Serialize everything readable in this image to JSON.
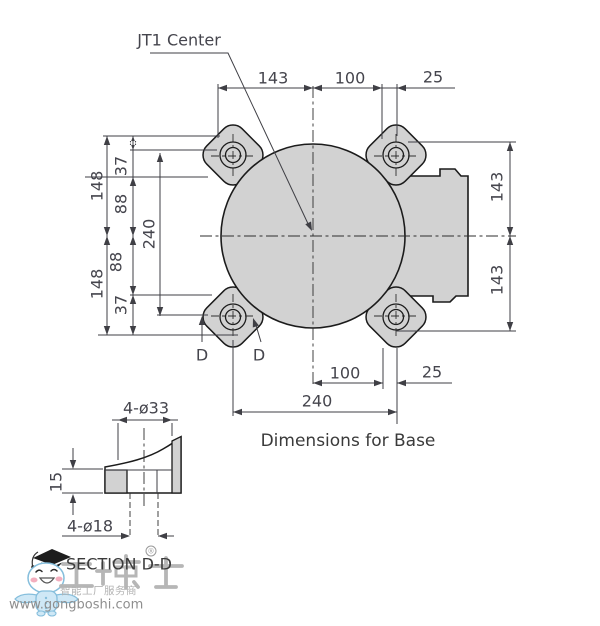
{
  "drawing": {
    "callout": "JT1 Center",
    "caption": "Dimensions for Base",
    "cut_labels": {
      "left": "D",
      "right": "D"
    },
    "dims": {
      "top": [
        "143",
        "100",
        "25"
      ],
      "bottom": [
        "100",
        "25",
        "240"
      ],
      "left": [
        "148",
        "37",
        "88",
        "240",
        "88",
        "37",
        "148"
      ],
      "right": [
        "143",
        "143"
      ]
    },
    "section": {
      "caption": "SECTION D-D",
      "counterbore": "4-ø33",
      "thickness": "15",
      "through_hole": "4-ø18"
    }
  },
  "watermark": {
    "brand": "工博士",
    "registered": "®",
    "tagline": "智能工厂服务商",
    "url": "www.gongboshi.com"
  },
  "colors": {
    "part_fill": "#d2d2d2",
    "outline": "#1b1b1b",
    "dim_text": "#45454d",
    "watermark_gray": "#b6b6b6",
    "mascot_blue": "#cfe8f6",
    "mascot_outline_blue": "#85bedc",
    "cheek_pink": "#f3aebe"
  }
}
